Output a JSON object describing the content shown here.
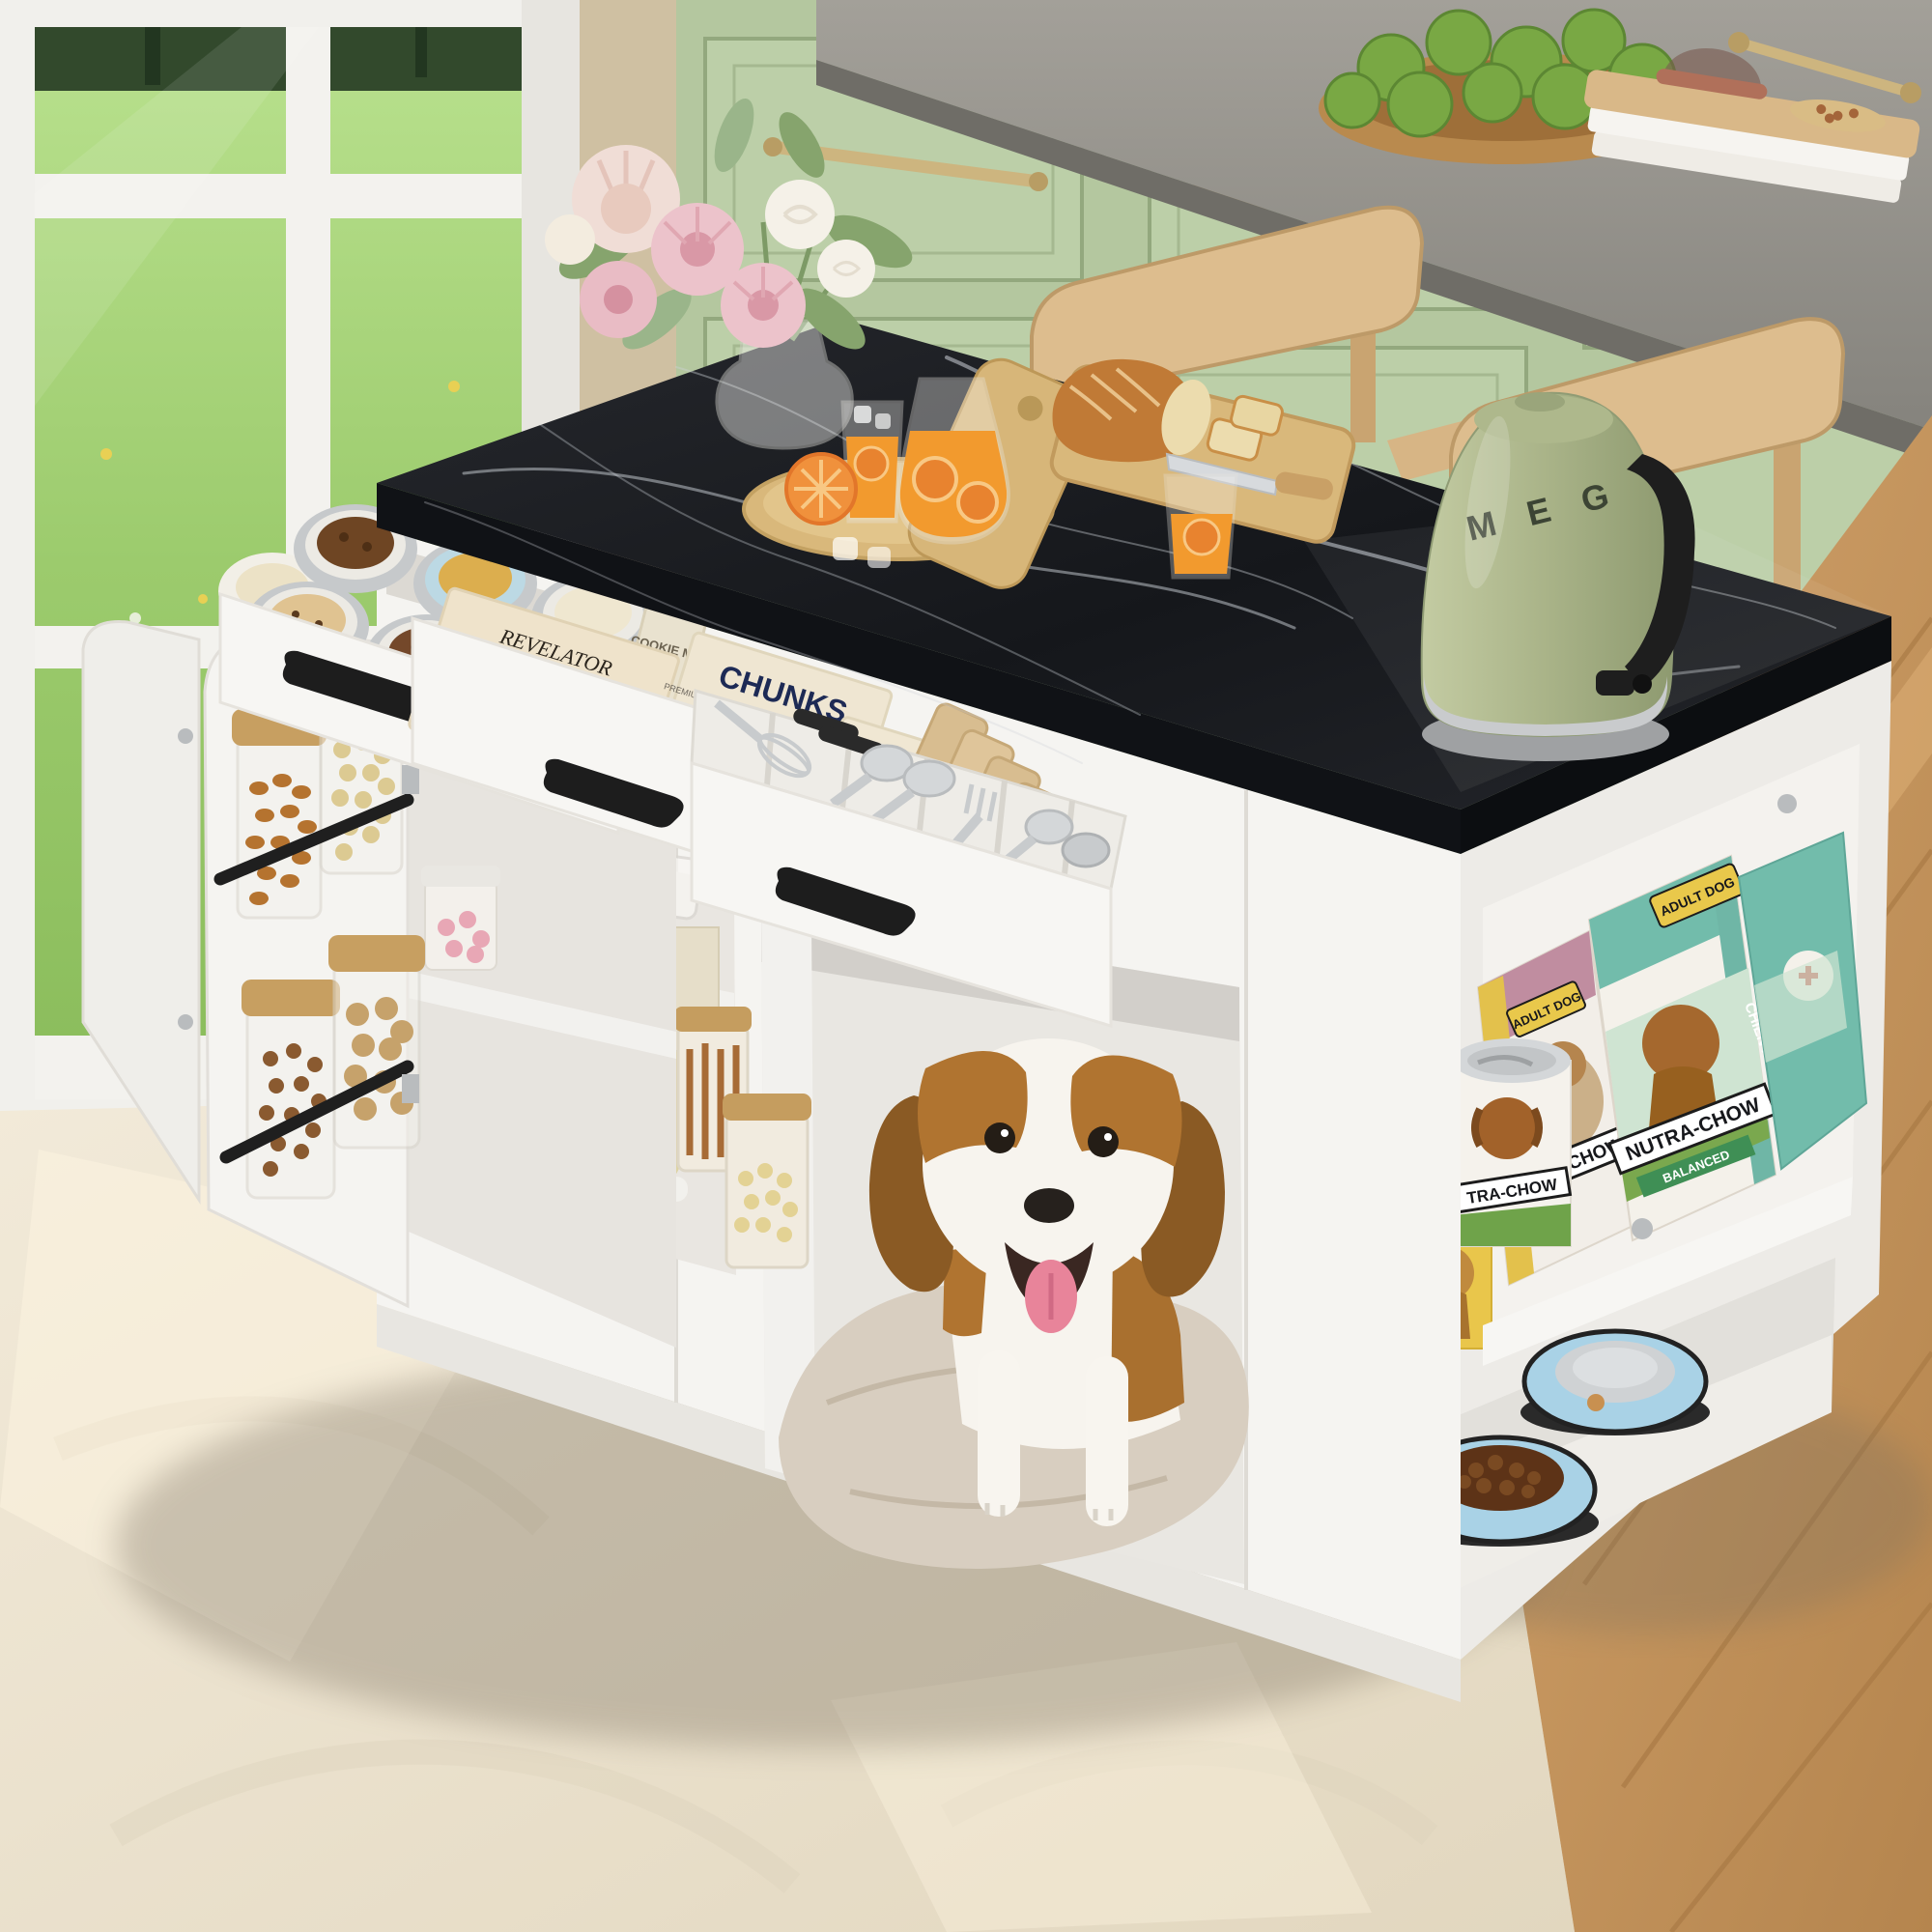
{
  "meta": {
    "kind": "product-photo",
    "subject": "Kitchen island with dog den, open storage drawers, pet food shelves, beagle dog, green kitchen backdrop"
  },
  "labels": {
    "kettle_logo": "M E G",
    "coffee_box": {
      "brand": "REVELATOR",
      "sub": "COFFEE COMPANY",
      "name": "PALE RIDER"
    },
    "chunks_box": {
      "title": "CHUNKS",
      "tagline": "PREMIUM CHOCOLATE FOR DESSERTS AND PASTRIES"
    },
    "cookie_tins": {
      "label": "COOKIE MIX"
    },
    "dog_food": {
      "brand": "NUTRA-CHOW",
      "type_en": "ADULT DOG",
      "type_fr": "CHIEN ADULTE",
      "sub": "BALANCED",
      "can_brand": "TRA-CHOW"
    }
  },
  "palette": {
    "cabinet_green": "#b4c79f",
    "marble_black": "#17191d",
    "island_white": "#f5f4f1",
    "kettle_green": "#a9b388",
    "brass": "#cdb57f",
    "oak_chair": "#d9b98c",
    "rug_cream": "#ece3d2",
    "floor_wood": "#c9995f",
    "bag_teal": "#72bcab",
    "bag_pink": "#c08da0",
    "accent_yellow": "#e9c84b",
    "bowl_blue": "#a9d2e6",
    "juice_orange": "#f29a2e",
    "grass_green": "#9ccb6d"
  }
}
